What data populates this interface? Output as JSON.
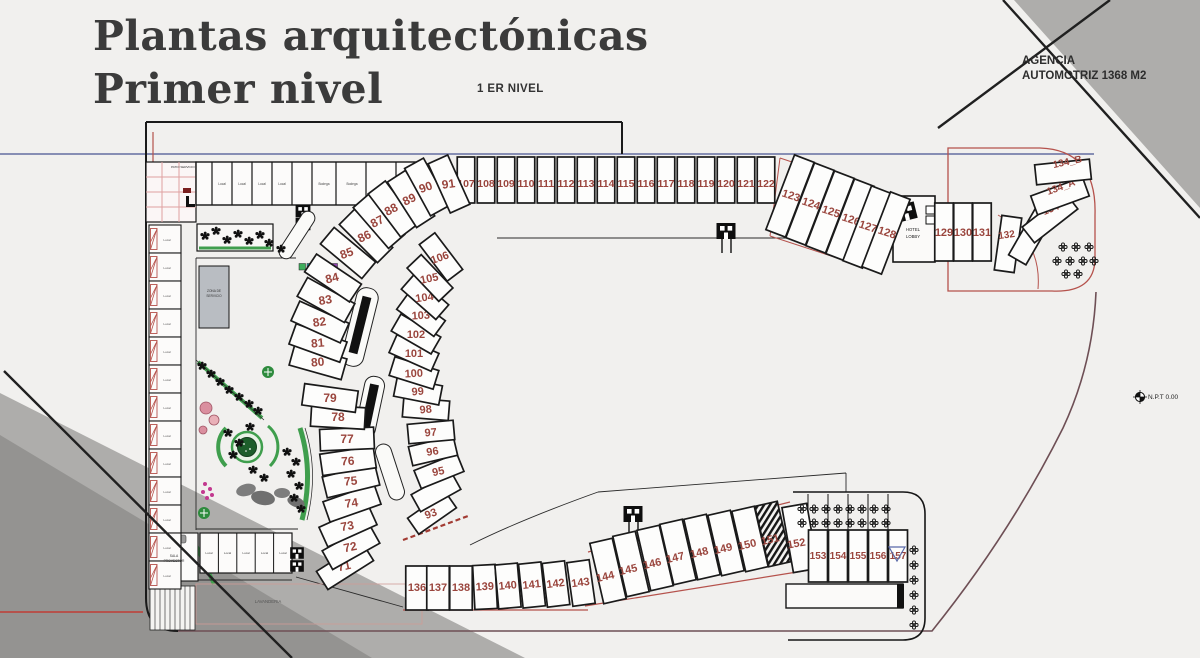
{
  "page": {
    "title_line1": "Plantas arquitectónicas",
    "title_line2": "Primer nivel",
    "level_label": "1 ER NIVEL",
    "agency_line1": "AGENCIA",
    "agency_line2": "AUTOMOTRIZ 1368 M2",
    "npt_label": "N.P.T 0.00"
  },
  "plan": {
    "hotel_lobby": {
      "line1": "HOTEL",
      "line2": "LOBBY"
    },
    "zona": {
      "line1": "ZONA DE",
      "line2": "SERVICIO"
    },
    "patio_label": "PATIO SERVICIO",
    "laundry_label": "LAVANDERIA",
    "sala": {
      "line1": "SALA",
      "line2": "PROYECTOR"
    },
    "room_label": "Local",
    "bodega_label": "Bodega",
    "units": {
      "top_row": [
        "107",
        "108",
        "109",
        "110",
        "111",
        "112",
        "113",
        "114",
        "115",
        "116",
        "117",
        "118",
        "119",
        "120",
        "121",
        "122"
      ],
      "outer_arc": [
        "71",
        "72",
        "73",
        "74",
        "75",
        "76",
        "77",
        "78",
        "79",
        "80",
        "81",
        "82",
        "83",
        "84",
        "85",
        "86",
        "87",
        "88",
        "89",
        "90",
        "91"
      ],
      "inner_arc": [
        "93",
        "",
        "95",
        "96",
        "97",
        "98",
        "99",
        "100",
        "101",
        "102",
        "103",
        "104",
        "105",
        "106"
      ],
      "right_row": [
        "123",
        "124",
        "125",
        "126",
        "127",
        "128"
      ],
      "hotel_row": [
        "129",
        "130",
        "131"
      ],
      "right_fan": [
        "132",
        "133",
        "134",
        "134_A",
        "134_B"
      ],
      "bottom_row": [
        "136",
        "137",
        "138",
        "139",
        "140",
        "141",
        "142",
        "143"
      ],
      "bottom_slant": [
        "144",
        "145",
        "146",
        "147",
        "148",
        "149",
        "150",
        "151"
      ],
      "unit_152": "152",
      "bottom_block": [
        "153",
        "154",
        "155",
        "156",
        "157"
      ],
      "top_rooms": [
        "Local",
        "Local",
        "Local",
        "Local",
        "Bodega",
        "Bodega"
      ],
      "bottom_rooms": [
        "Local",
        "Local",
        "Local",
        "Local",
        "Local"
      ]
    }
  },
  "colors": {
    "line": "#1a1a1a",
    "unit_number": "#9a453d",
    "outline_red": "#b5524c",
    "blue_line": "#646ea0",
    "boundary_maroon": "#6e4f55",
    "green": "#3f9e4d",
    "tree_green": "#1d5e2b",
    "gray_triangle_light": "#aeadab",
    "gray_triangle_dark": "#949391",
    "building_gray": "#b9bdc2"
  },
  "icons": {
    "elevator-icon": "■",
    "flower-icon": "⁘",
    "tree-icon": "✽",
    "crosshair-icon": "✛",
    "ramp-triangle-icon": "▽",
    "stairs-icon": "≋"
  }
}
